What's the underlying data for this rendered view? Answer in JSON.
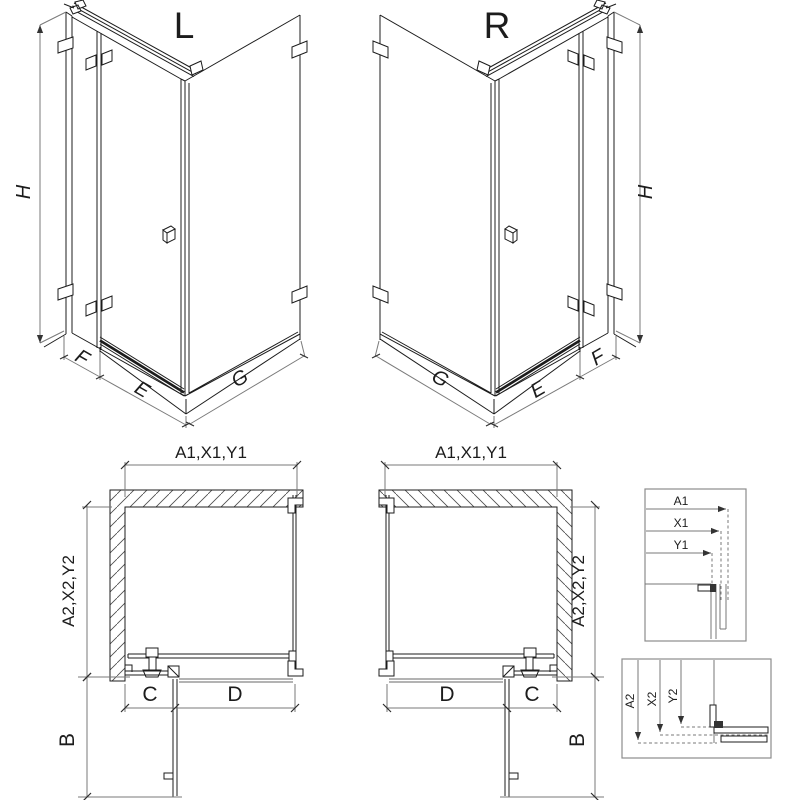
{
  "views": {
    "iso_left": {
      "title": "L",
      "height": "H",
      "panel_fixed": "F",
      "door": "E",
      "side_panel": "G"
    },
    "iso_right": {
      "title": "R",
      "height": "H",
      "panel_fixed": "F",
      "door": "E",
      "side_panel": "G"
    },
    "plan_left": {
      "width_top": "A1,X1,Y1",
      "depth_side": "A2,X2,Y2",
      "fixed_segment": "C",
      "door_opening": "D",
      "door_projection": "B"
    },
    "plan_right": {
      "width_top": "A1,X1,Y1",
      "depth_side": "A2,X2,Y2",
      "fixed_segment": "C",
      "door_opening": "D",
      "door_projection": "B"
    },
    "detail_width": {
      "labels": [
        "A1",
        "X1",
        "Y1"
      ]
    },
    "detail_depth": {
      "labels": [
        "A2",
        "X2",
        "Y2"
      ]
    }
  },
  "colors": {
    "line": "#1c1c1c",
    "dimension": "#7a7a7a",
    "glass_gray": "#9a9a9a",
    "detail_border": "#8c8c8c",
    "background": "#ffffff"
  }
}
